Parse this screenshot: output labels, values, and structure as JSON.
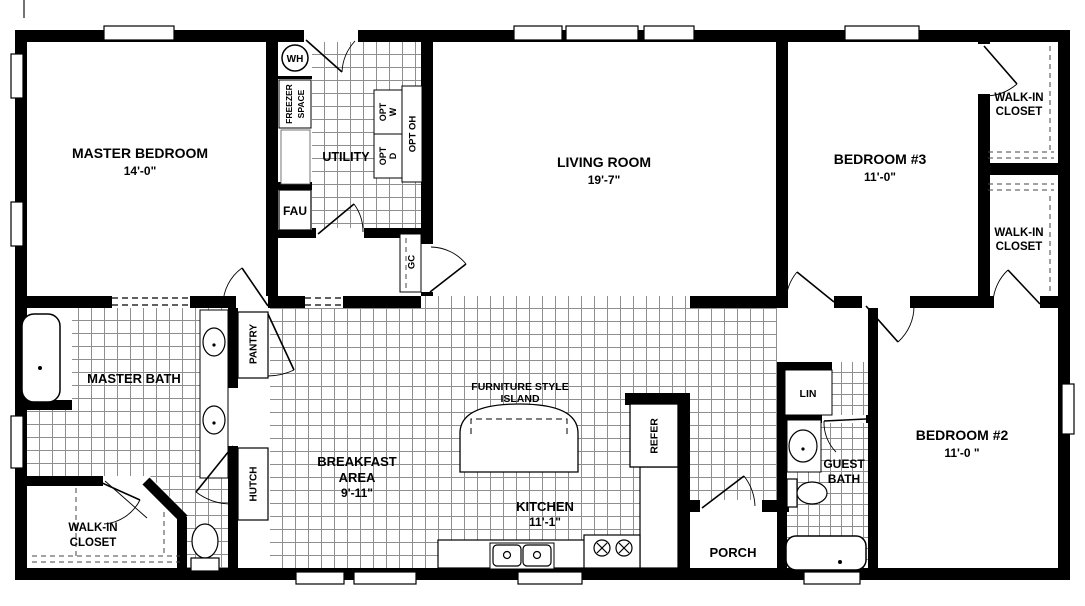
{
  "plan": {
    "rooms": {
      "master_bedroom": {
        "name": "MASTER BEDROOM",
        "dim": "14'-0\""
      },
      "living_room": {
        "name": "LIVING ROOM",
        "dim": "19'-7\""
      },
      "bedroom3": {
        "name": "BEDROOM #3",
        "dim": "11'-0\""
      },
      "bedroom2": {
        "name": "BEDROOM #2",
        "dim": "11'-0 \""
      },
      "walk_in_closet": {
        "line1": "WALK-IN",
        "line2": "CLOSET"
      },
      "master_bath": {
        "name": "MASTER BATH"
      },
      "breakfast": {
        "line1": "BREAKFAST",
        "line2": "AREA",
        "dim": "9'-11\""
      },
      "kitchen": {
        "name": "KITCHEN",
        "dim": "11'-1\""
      },
      "guest_bath": {
        "line1": "GUEST",
        "line2": "BATH"
      },
      "porch": {
        "name": "PORCH"
      },
      "utility": {
        "name": "UTILITY"
      }
    },
    "fixtures": {
      "wh": "WH",
      "fau": "FAU",
      "freezer_line1": "FREEZER",
      "freezer_line2": "SPACE",
      "opt_w_line1": "OPT",
      "opt_w_line2": "W",
      "opt_d_line1": "OPT",
      "opt_d_line2": "D",
      "opt_oh": "OPT OH",
      "gc": "GC",
      "pantry": "PANTRY",
      "hutch": "HUTCH",
      "refer": "REFER",
      "lin": "LIN",
      "island_line1": "FURNITURE STYLE",
      "island_line2": "ISLAND"
    },
    "colors": {
      "wall": "#000000",
      "tile_line": "#8f8f8f",
      "bg": "#ffffff"
    }
  }
}
